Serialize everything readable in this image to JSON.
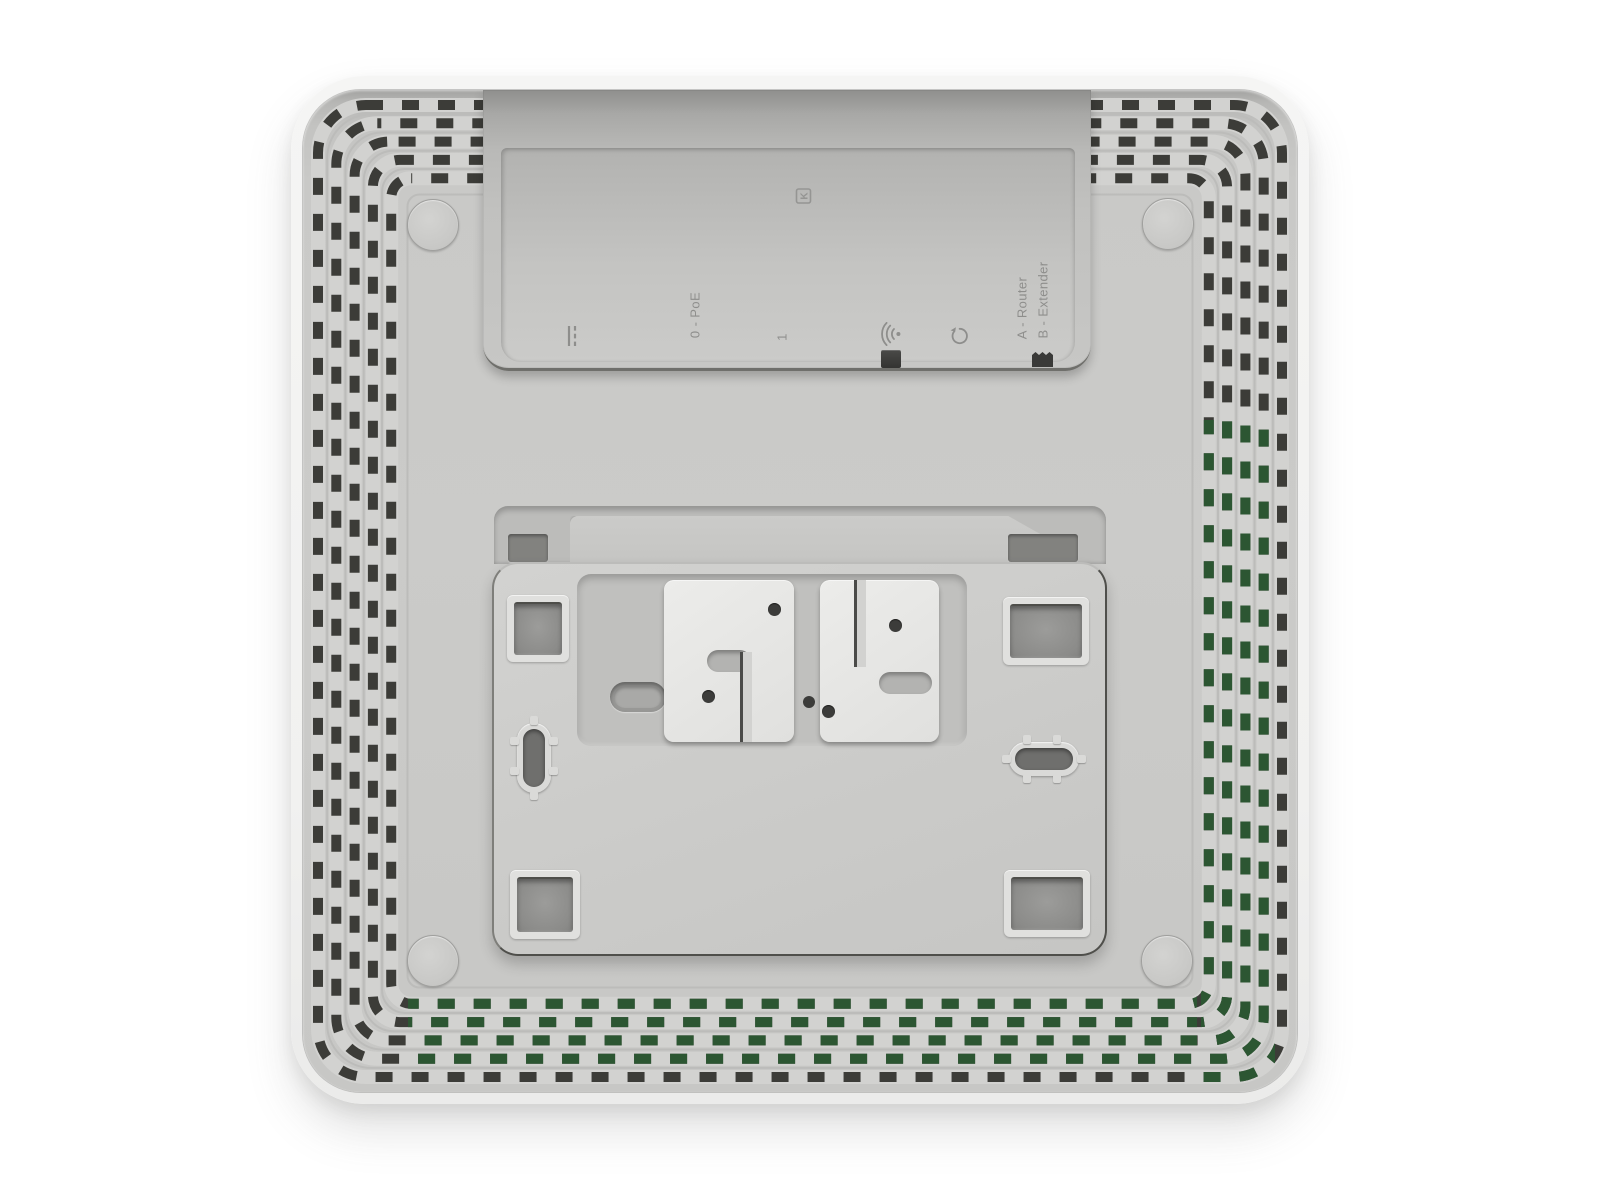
{
  "scene": {
    "type": "product-photo",
    "description": "Rear view of a white square mesh Wi-Fi node showing ventilation grille, recessed port panel and wall-mount bracket plate",
    "background": "#ffffff"
  },
  "port_panel": {
    "port0_label": "0 - PoE",
    "port1_label": "1",
    "mode_a_label": "A - Router",
    "mode_b_label": "B - Extender",
    "kensington_letter": "K"
  },
  "colors": {
    "shell": "#f3f3f2",
    "panel": "#c9c9c7",
    "vent_slot": "#3c3c38",
    "vent_slot_green": "#2c5632",
    "cavity_wall": "#a6a6a4",
    "label_text": "#8e8e8c",
    "bracket_clip": "#e6e6e4",
    "control_dark": "#3a3a38"
  },
  "decor": {
    "vents": {
      "count": 5,
      "inset_start": 15,
      "pitch": 18.3,
      "radius_start": 48,
      "radius_step": 7,
      "slot_width": 10,
      "dash": "17 19",
      "w": 994,
      "h": 1002,
      "ridge": "#d2d2d0",
      "groove": "#bcbcba",
      "slot": "#3c3c38",
      "slot_green": "#2c5632",
      "green_zones": [
        {
          "x": 898,
          "y": 330,
          "w": 74,
          "h": 675
        },
        {
          "x": 105,
          "y": 905,
          "w": 789,
          "h": 70
        }
      ]
    }
  }
}
